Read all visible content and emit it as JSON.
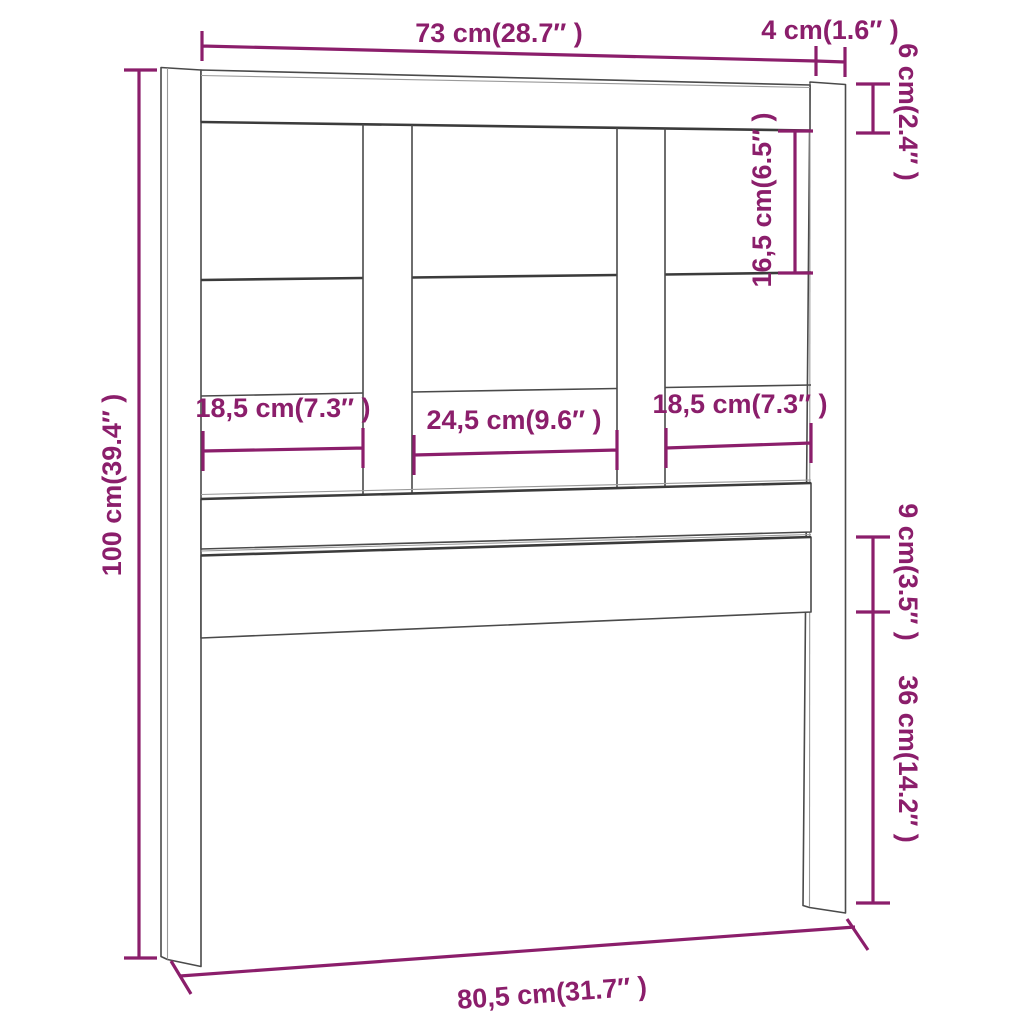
{
  "drawing": {
    "description": "Bed headboard technical line drawing with dimension annotations",
    "parts": {
      "left_post": "left-post",
      "right_post": "right-post",
      "top_rail": "top-rail",
      "middle_rail": "middle-rail",
      "upper_bottom_rail": "upper-bottom-rail",
      "lower_bottom_rail": "lower-bottom-rail",
      "slat_1": "vertical-slat-1",
      "slat_2": "vertical-slat-2"
    }
  },
  "labels": {
    "top_inner_width": "73 cm(28.7″ )",
    "post_width": "4 cm(1.6″ )",
    "top_rail_height": "6 cm(2.4″ )",
    "upper_opening_height": "16,5 cm(6.5″ )",
    "left_opening_width": "18,5 cm(7.3″ )",
    "middle_opening_width": "24,5 cm(9.6″ )",
    "right_opening_width": "18,5 cm(7.3″ )",
    "total_height": "100 cm(39.4″ )",
    "lower_rail_height": "9 cm(3.5″ )",
    "leg_height": "36 cm(14.2″ )",
    "bottom_width": "80,5 cm(31.7″ )"
  },
  "colors": {
    "dimension": "#8B1E6B",
    "line_art": "#4a4a4a",
    "background": "#ffffff"
  }
}
